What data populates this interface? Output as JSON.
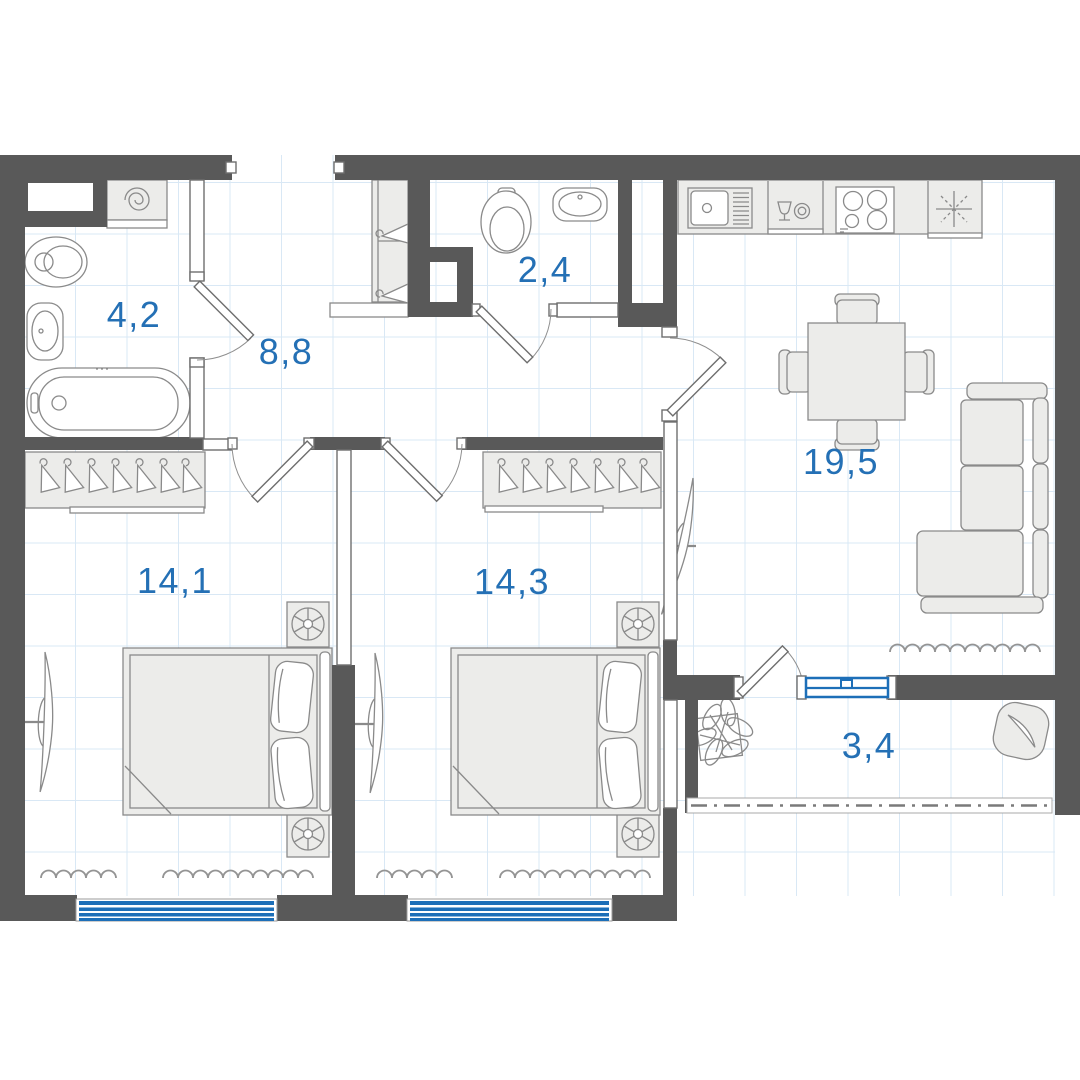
{
  "plan_title": "2-room apartment floor plan",
  "rooms": [
    {
      "id": "bathroom",
      "area": "4,2"
    },
    {
      "id": "hallway",
      "area": "8,8"
    },
    {
      "id": "wc",
      "area": "2,4"
    },
    {
      "id": "kitchen-living-room",
      "area": "19,5"
    },
    {
      "id": "bedroom-1",
      "area": "14,1"
    },
    {
      "id": "bedroom-2",
      "area": "14,3"
    },
    {
      "id": "balcony",
      "area": "3,4"
    }
  ],
  "colors": {
    "wall": "#595959",
    "blue": "#1d6fb8",
    "label": "#2470b5",
    "furn": "#ececea",
    "stroke": "#8a8a8a",
    "grid": "#d9e8f5"
  },
  "fixtures": [
    "washing-machine-icon",
    "toilet-icon",
    "washbasin-icon",
    "bathtub-icon",
    "hanger-icon",
    "kitchen-sink-icon",
    "dishwasher-icon",
    "cooktop-icon",
    "refrigerator-asterisk-icon",
    "dining-table-icon",
    "chair-icon",
    "sofa-icon",
    "tv-icon",
    "double-bed-icon",
    "nightstand-lamp-icon",
    "radiator-icon",
    "window-icon",
    "balcony-glazing-icon",
    "plant-icon",
    "pouf-icon",
    "door-swing-icon"
  ]
}
